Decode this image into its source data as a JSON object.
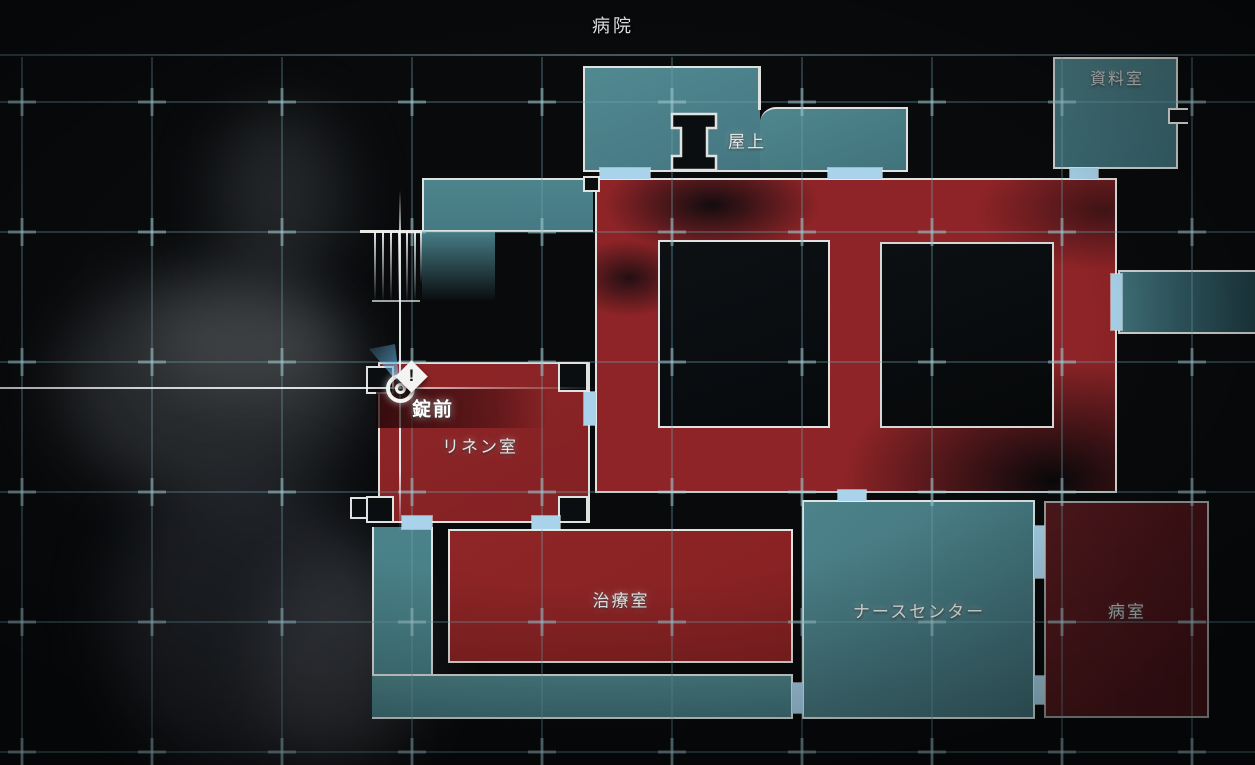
{
  "header": {
    "title": "病院"
  },
  "map": {
    "rooms": {
      "rooftop": "屋上",
      "archive": "資料室",
      "linen": "リネン室",
      "treatment": "治療室",
      "nurse_station": "ナースセンター",
      "sickroom": "病室"
    },
    "marker": {
      "label": "錠前",
      "icon": "exclamation-diamond-icon",
      "glyph": "!"
    },
    "colors": {
      "explored_room": "#4c8289",
      "item_room": "#8e2427",
      "unvisited_room": "#471419",
      "door": "#a8d3ea",
      "wall": "#dfe2de",
      "grid": "#6fa3ad"
    }
  }
}
